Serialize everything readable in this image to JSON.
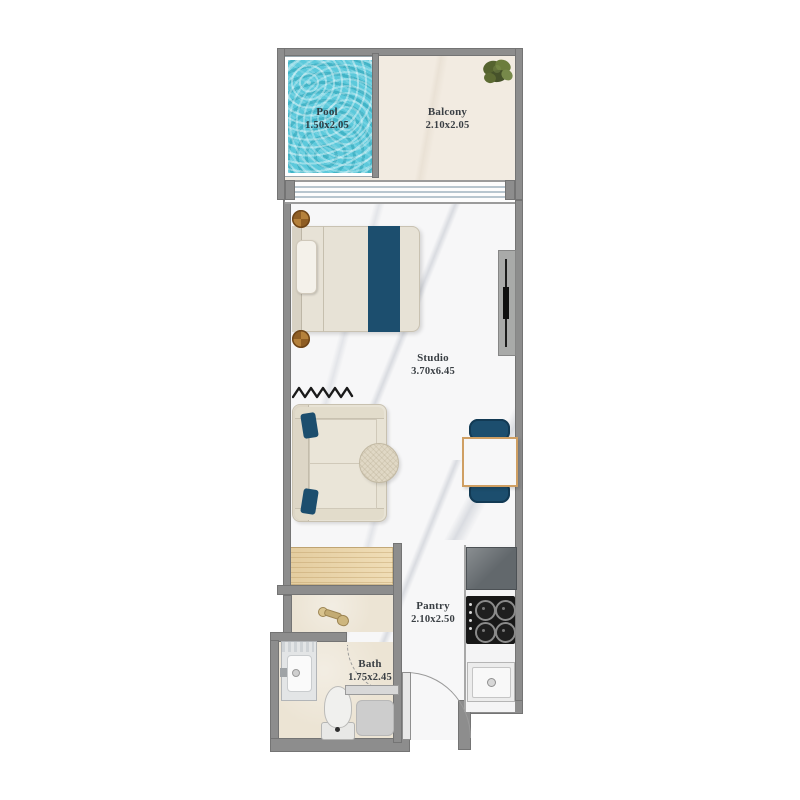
{
  "rooms": {
    "pool": {
      "label": "Pool",
      "dims": "1.50x2.05"
    },
    "balcony": {
      "label": "Balcony",
      "dims": "2.10x2.05"
    },
    "studio": {
      "label": "Studio",
      "dims": "3.70x6.45"
    },
    "pantry": {
      "label": "Pantry",
      "dims": "2.10x2.50"
    },
    "bath": {
      "label": "Bath",
      "dims": "1.75x2.45"
    }
  },
  "colors": {
    "wall": "#8d8d8d",
    "pool_water": "#5cc9db",
    "navy_accent": "#1c4e6e",
    "wood": "#eedbb4",
    "bath_floor": "#ece4d4",
    "balcony_floor": "#f2ebe1",
    "copper": "#a9752f",
    "gold_fixture": "#b59a5f",
    "label_text": "#3a3f44"
  }
}
